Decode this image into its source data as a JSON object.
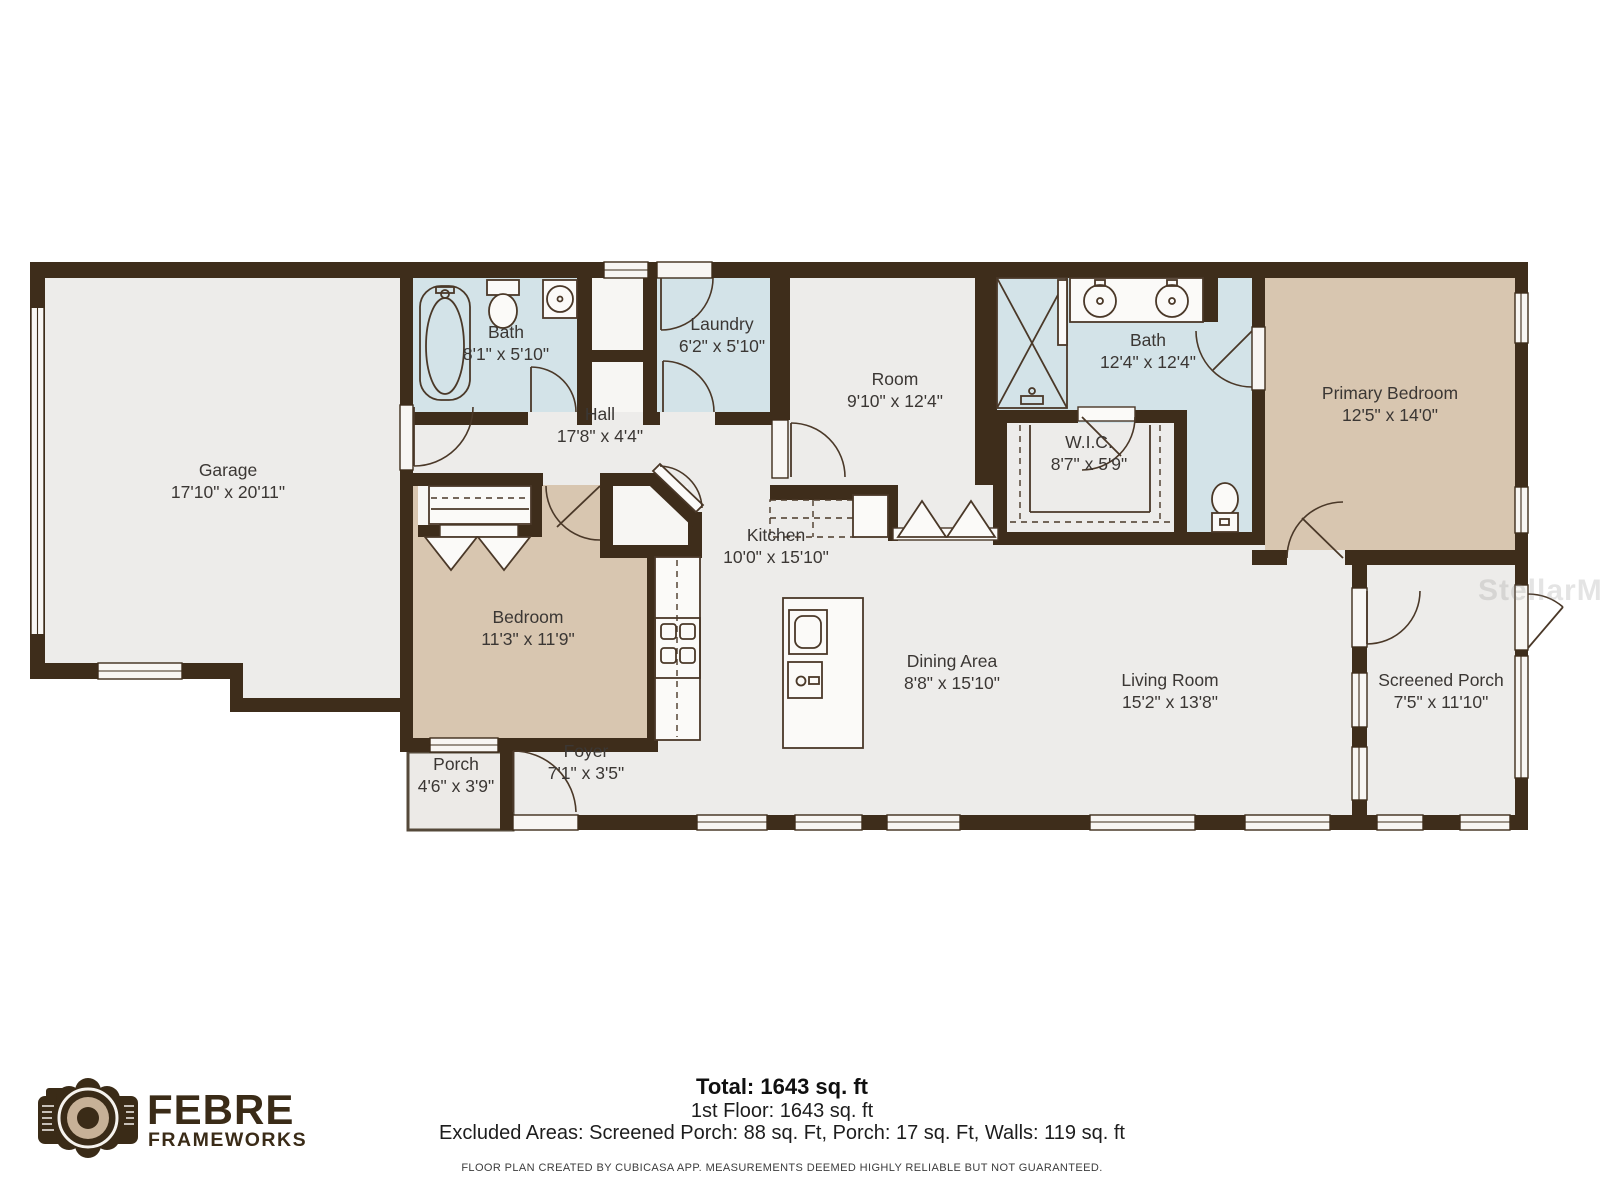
{
  "rooms": {
    "garage": {
      "name": "Garage",
      "dims": "17'10\" x 20'11\""
    },
    "bath1": {
      "name": "Bath",
      "dims": "8'1\" x 5'10\""
    },
    "laundry": {
      "name": "Laundry",
      "dims": "6'2\" x 5'10\""
    },
    "hall": {
      "name": "Hall",
      "dims": "17'8\" x 4'4\""
    },
    "room": {
      "name": "Room",
      "dims": "9'10\" x 12'4\""
    },
    "bath2": {
      "name": "Bath",
      "dims": "12'4\" x 12'4\""
    },
    "wic": {
      "name": "W.I.C.",
      "dims": "8'7\" x 5'9\""
    },
    "primary_bedroom": {
      "name": "Primary Bedroom",
      "dims": "12'5\" x 14'0\""
    },
    "bedroom": {
      "name": "Bedroom",
      "dims": "11'3\" x 11'9\""
    },
    "kitchen": {
      "name": "Kitchen",
      "dims": "10'0\" x 15'10\""
    },
    "dining": {
      "name": "Dining Area",
      "dims": "8'8\" x 15'10\""
    },
    "living": {
      "name": "Living Room",
      "dims": "15'2\" x 13'8\""
    },
    "screened_porch": {
      "name": "Screened Porch",
      "dims": "7'5\" x 11'10\""
    },
    "porch": {
      "name": "Porch",
      "dims": "4'6\" x 3'9\""
    },
    "foyer": {
      "name": "Foyer",
      "dims": "7'1\" x 3'5\""
    }
  },
  "footer": {
    "total": "Total: 1643 sq. ft",
    "floor1": "1st Floor: 1643 sq. ft",
    "excluded": "Excluded Areas: Screened Porch: 88 sq. Ft, Porch: 17 sq. Ft, Walls: 119 sq. ft",
    "disclaimer": "FLOOR PLAN CREATED BY CUBICASA APP. MEASUREMENTS DEEMED HIGHLY RELIABLE BUT NOT GUARANTEED."
  },
  "logo": {
    "line1": "FEBRE",
    "line2": "FRAMEWORKS",
    "icon": "camera-icon"
  },
  "watermark": "StellarMLS",
  "colors": {
    "wall": "#3e2d1b",
    "floor": "#edecea",
    "wet_room": "#d3e3e8",
    "bedroom": "#d8c6b0",
    "background": "#ffffff"
  }
}
